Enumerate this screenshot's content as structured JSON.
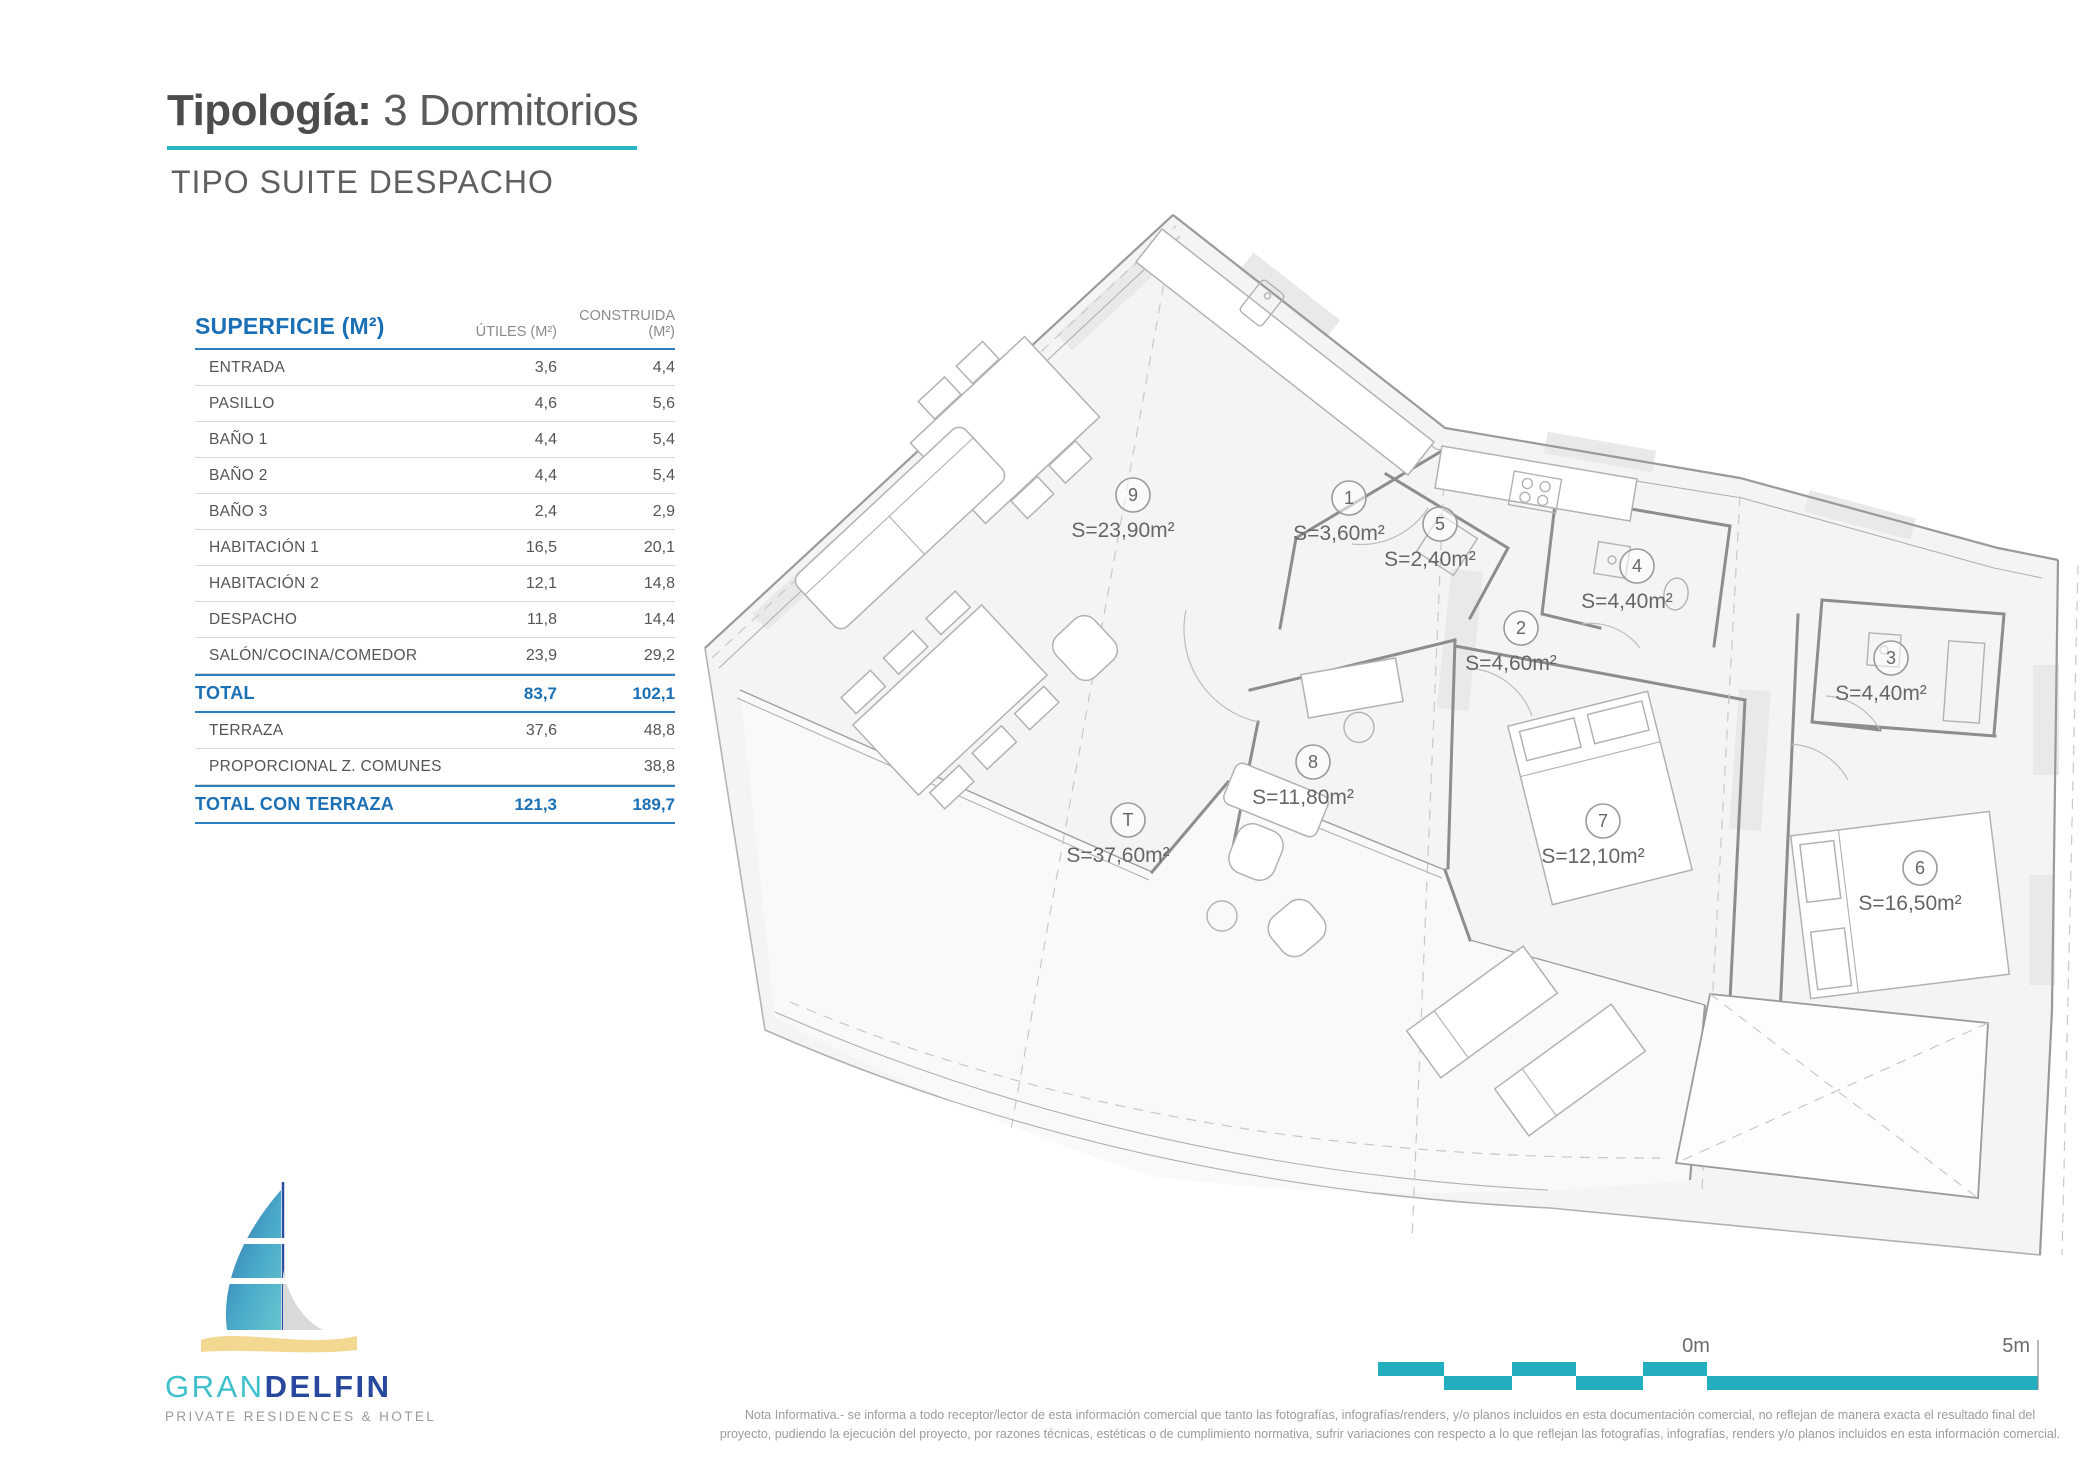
{
  "header": {
    "title_label": "Tipología:",
    "title_value": "3 Dormitorios",
    "subtitle": "TIPO SUITE DESPACHO"
  },
  "surface_table": {
    "title": "SUPERFICIE (M²)",
    "col_utiles": "ÚTILES (M²)",
    "col_construida": "CONSTRUIDA (M²)",
    "rows": [
      {
        "label": "ENTRADA",
        "utiles": "3,6",
        "construida": "4,4",
        "style": "normal"
      },
      {
        "label": "PASILLO",
        "utiles": "4,6",
        "construida": "5,6",
        "style": "normal"
      },
      {
        "label": "BAÑO 1",
        "utiles": "4,4",
        "construida": "5,4",
        "style": "normal"
      },
      {
        "label": "BAÑO 2",
        "utiles": "4,4",
        "construida": "5,4",
        "style": "normal"
      },
      {
        "label": "BAÑO 3",
        "utiles": "2,4",
        "construida": "2,9",
        "style": "normal"
      },
      {
        "label": "HABITACIÓN 1",
        "utiles": "16,5",
        "construida": "20,1",
        "style": "normal"
      },
      {
        "label": "HABITACIÓN 2",
        "utiles": "12,1",
        "construida": "14,8",
        "style": "normal"
      },
      {
        "label": "DESPACHO",
        "utiles": "11,8",
        "construida": "14,4",
        "style": "normal"
      },
      {
        "label": "SALÓN/COCINA/COMEDOR",
        "utiles": "23,9",
        "construida": "29,2",
        "style": "normal"
      },
      {
        "label": "TOTAL",
        "utiles": "83,7",
        "construida": "102,1",
        "style": "total"
      },
      {
        "label": "TERRAZA",
        "utiles": "37,6",
        "construida": "48,8",
        "style": "normal"
      },
      {
        "label": "PROPORCIONAL Z. COMUNES",
        "utiles": "",
        "construida": "38,8",
        "style": "normal"
      },
      {
        "label": "TOTAL CON TERRAZA",
        "utiles": "121,3",
        "construida": "189,7",
        "style": "total"
      }
    ]
  },
  "plan": {
    "rooms": [
      {
        "id": "9",
        "area": "S=23,90m²"
      },
      {
        "id": "1",
        "area": "S=3,60m²"
      },
      {
        "id": "5",
        "area": "S=2,40m²"
      },
      {
        "id": "2",
        "area": "S=4,60m²"
      },
      {
        "id": "4",
        "area": "S=4,40m²"
      },
      {
        "id": "3",
        "area": "S=4,40m²"
      },
      {
        "id": "8",
        "area": "S=11,80m²"
      },
      {
        "id": "7",
        "area": "S=12,10m²"
      },
      {
        "id": "6",
        "area": "S=16,50m²"
      },
      {
        "id": "T",
        "area": "S=37,60m²"
      }
    ]
  },
  "scale_bar": {
    "label_start": "0m",
    "label_end": "5m"
  },
  "logo": {
    "brand_gran": "GRAN",
    "brand_delfin": "DELFIN",
    "tagline": "PRIVATE RESIDENCES & HOTEL"
  },
  "footer": {
    "note_line1": "Nota Informativa.- se informa a todo receptor/lector de esta información comercial que tanto las fotografías, infografías/renders, y/o planos incluidos en esta documentación comercial, no reflejan de manera exacta el resultado final del",
    "note_line2": "proyecto, pudiendo la ejecución del proyecto, por razones técnicas, estéticas o de cumplimiento normativa, sufrir variaciones con respecto a lo que reflejan las fotografías, infografías, renders y/o planos incluidos en esta información comercial."
  },
  "colors": {
    "accent_teal": "#28b4c3",
    "accent_blue": "#1b6fb5"
  }
}
